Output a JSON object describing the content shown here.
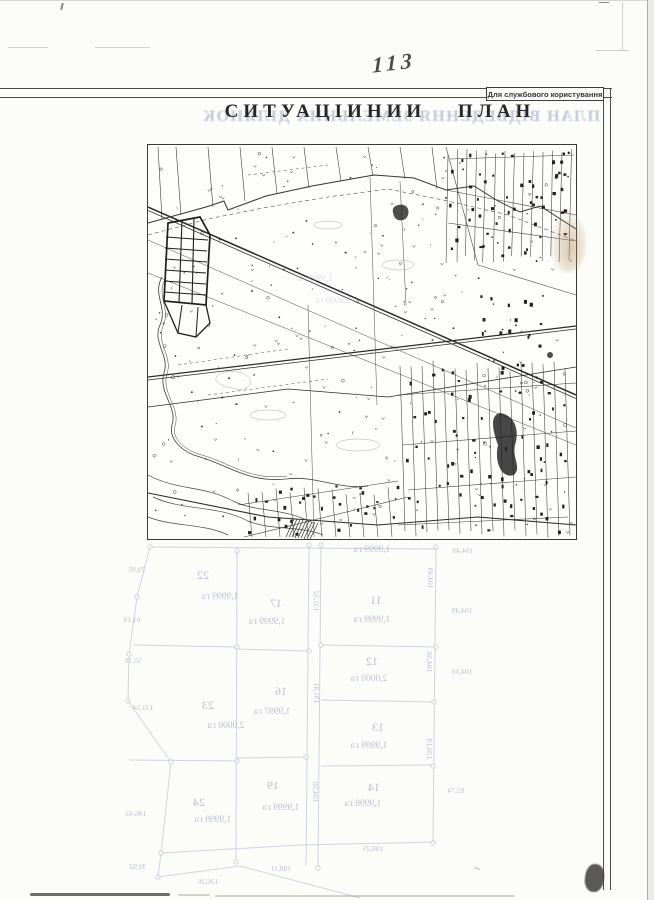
{
  "scan": {
    "page_number": "113",
    "classification_label": "Для службового користування",
    "title": "СИТУАЦІИНИИ  ПЛАН",
    "squiggle": "~"
  },
  "bleedthrough": {
    "reverse_title": "ПЛАН ВІДВЕДЕННЯ ЗЕМЕЛЬНИХ ДІЛЯНОК",
    "area_unit": "га",
    "parcels": [
      {
        "number": "22",
        "area": "1,9999 га",
        "nx": 203,
        "ny": 579,
        "ax": 220,
        "ay": 599
      },
      {
        "number": "17",
        "area": "1,9999 га",
        "nx": 276,
        "ny": 607,
        "ax": 267,
        "ay": 624
      },
      {
        "number": "11",
        "area": "1,9999 га",
        "nx": 376,
        "ny": 604,
        "ax": 372,
        "ay": 622
      },
      {
        "number": "12",
        "area": "2,0000 га",
        "nx": 372,
        "ny": 665,
        "ax": 369,
        "ay": 681
      },
      {
        "number": "16",
        "area": "1,9997 га",
        "nx": 281,
        "ny": 695,
        "ax": 272,
        "ay": 714
      },
      {
        "number": "23",
        "area": "2,0000 га",
        "nx": 208,
        "ny": 709,
        "ax": 226,
        "ay": 728
      },
      {
        "number": "13",
        "area": "1,9999 га",
        "nx": 378,
        "ny": 731,
        "ax": 369,
        "ay": 748
      },
      {
        "number": "19",
        "area": "1,9999 га",
        "nx": 273,
        "ny": 789,
        "ax": 281,
        "ay": 810
      },
      {
        "number": "24",
        "area": "1,9998 га",
        "nx": 199,
        "ny": 806,
        "ax": 213,
        "ay": 822
      },
      {
        "number": "14",
        "area": "1,9998 га",
        "nx": 374,
        "ny": 791,
        "ax": 363,
        "ay": 806
      }
    ],
    "fragments": [
      {
        "text": "1,9999 га",
        "x": 372,
        "y": 552,
        "rot": 0
      }
    ],
    "map_fragments": [
      {
        "text": "1,9999 га",
        "x": 150,
        "y": 128
      },
      {
        "text": "2,0000 га",
        "x": 168,
        "y": 150
      }
    ],
    "measurements": [
      {
        "text": "79,95",
        "x": 137,
        "y": 572,
        "rot": 0
      },
      {
        "text": "61,19",
        "x": 132,
        "y": 622,
        "rot": 0
      },
      {
        "text": "55,10",
        "x": 133,
        "y": 663,
        "rot": 0
      },
      {
        "text": "131,54",
        "x": 143,
        "y": 710,
        "rot": 0
      },
      {
        "text": "146,43",
        "x": 136,
        "y": 816,
        "rot": 0
      },
      {
        "text": "39,92",
        "x": 138,
        "y": 869,
        "rot": 0
      },
      {
        "text": "198,25",
        "x": 373,
        "y": 851,
        "rot": 0
      },
      {
        "text": "198,11",
        "x": 281,
        "y": 871,
        "rot": 0
      },
      {
        "text": "126,26",
        "x": 208,
        "y": 884,
        "rot": 0
      },
      {
        "text": "104,49",
        "x": 463,
        "y": 553,
        "rot": 0
      },
      {
        "text": "104,49",
        "x": 462,
        "y": 613,
        "rot": 0
      },
      {
        "text": "104,50",
        "x": 462,
        "y": 674,
        "rot": 0
      },
      {
        "text": "82,74",
        "x": 456,
        "y": 793,
        "rot": 0
      },
      {
        "text": "104,49",
        "x": 428,
        "y": 578,
        "rot": 90
      },
      {
        "text": "104,50",
        "x": 427,
        "y": 662,
        "rot": 90
      },
      {
        "text": "120,19",
        "x": 427,
        "y": 749,
        "rot": 90
      },
      {
        "text": "131,52",
        "x": 314,
        "y": 601,
        "rot": 90
      },
      {
        "text": "191,81",
        "x": 314,
        "y": 693,
        "rot": 90
      },
      {
        "text": "104,50",
        "x": 313,
        "y": 792,
        "rot": 90
      }
    ]
  }
}
